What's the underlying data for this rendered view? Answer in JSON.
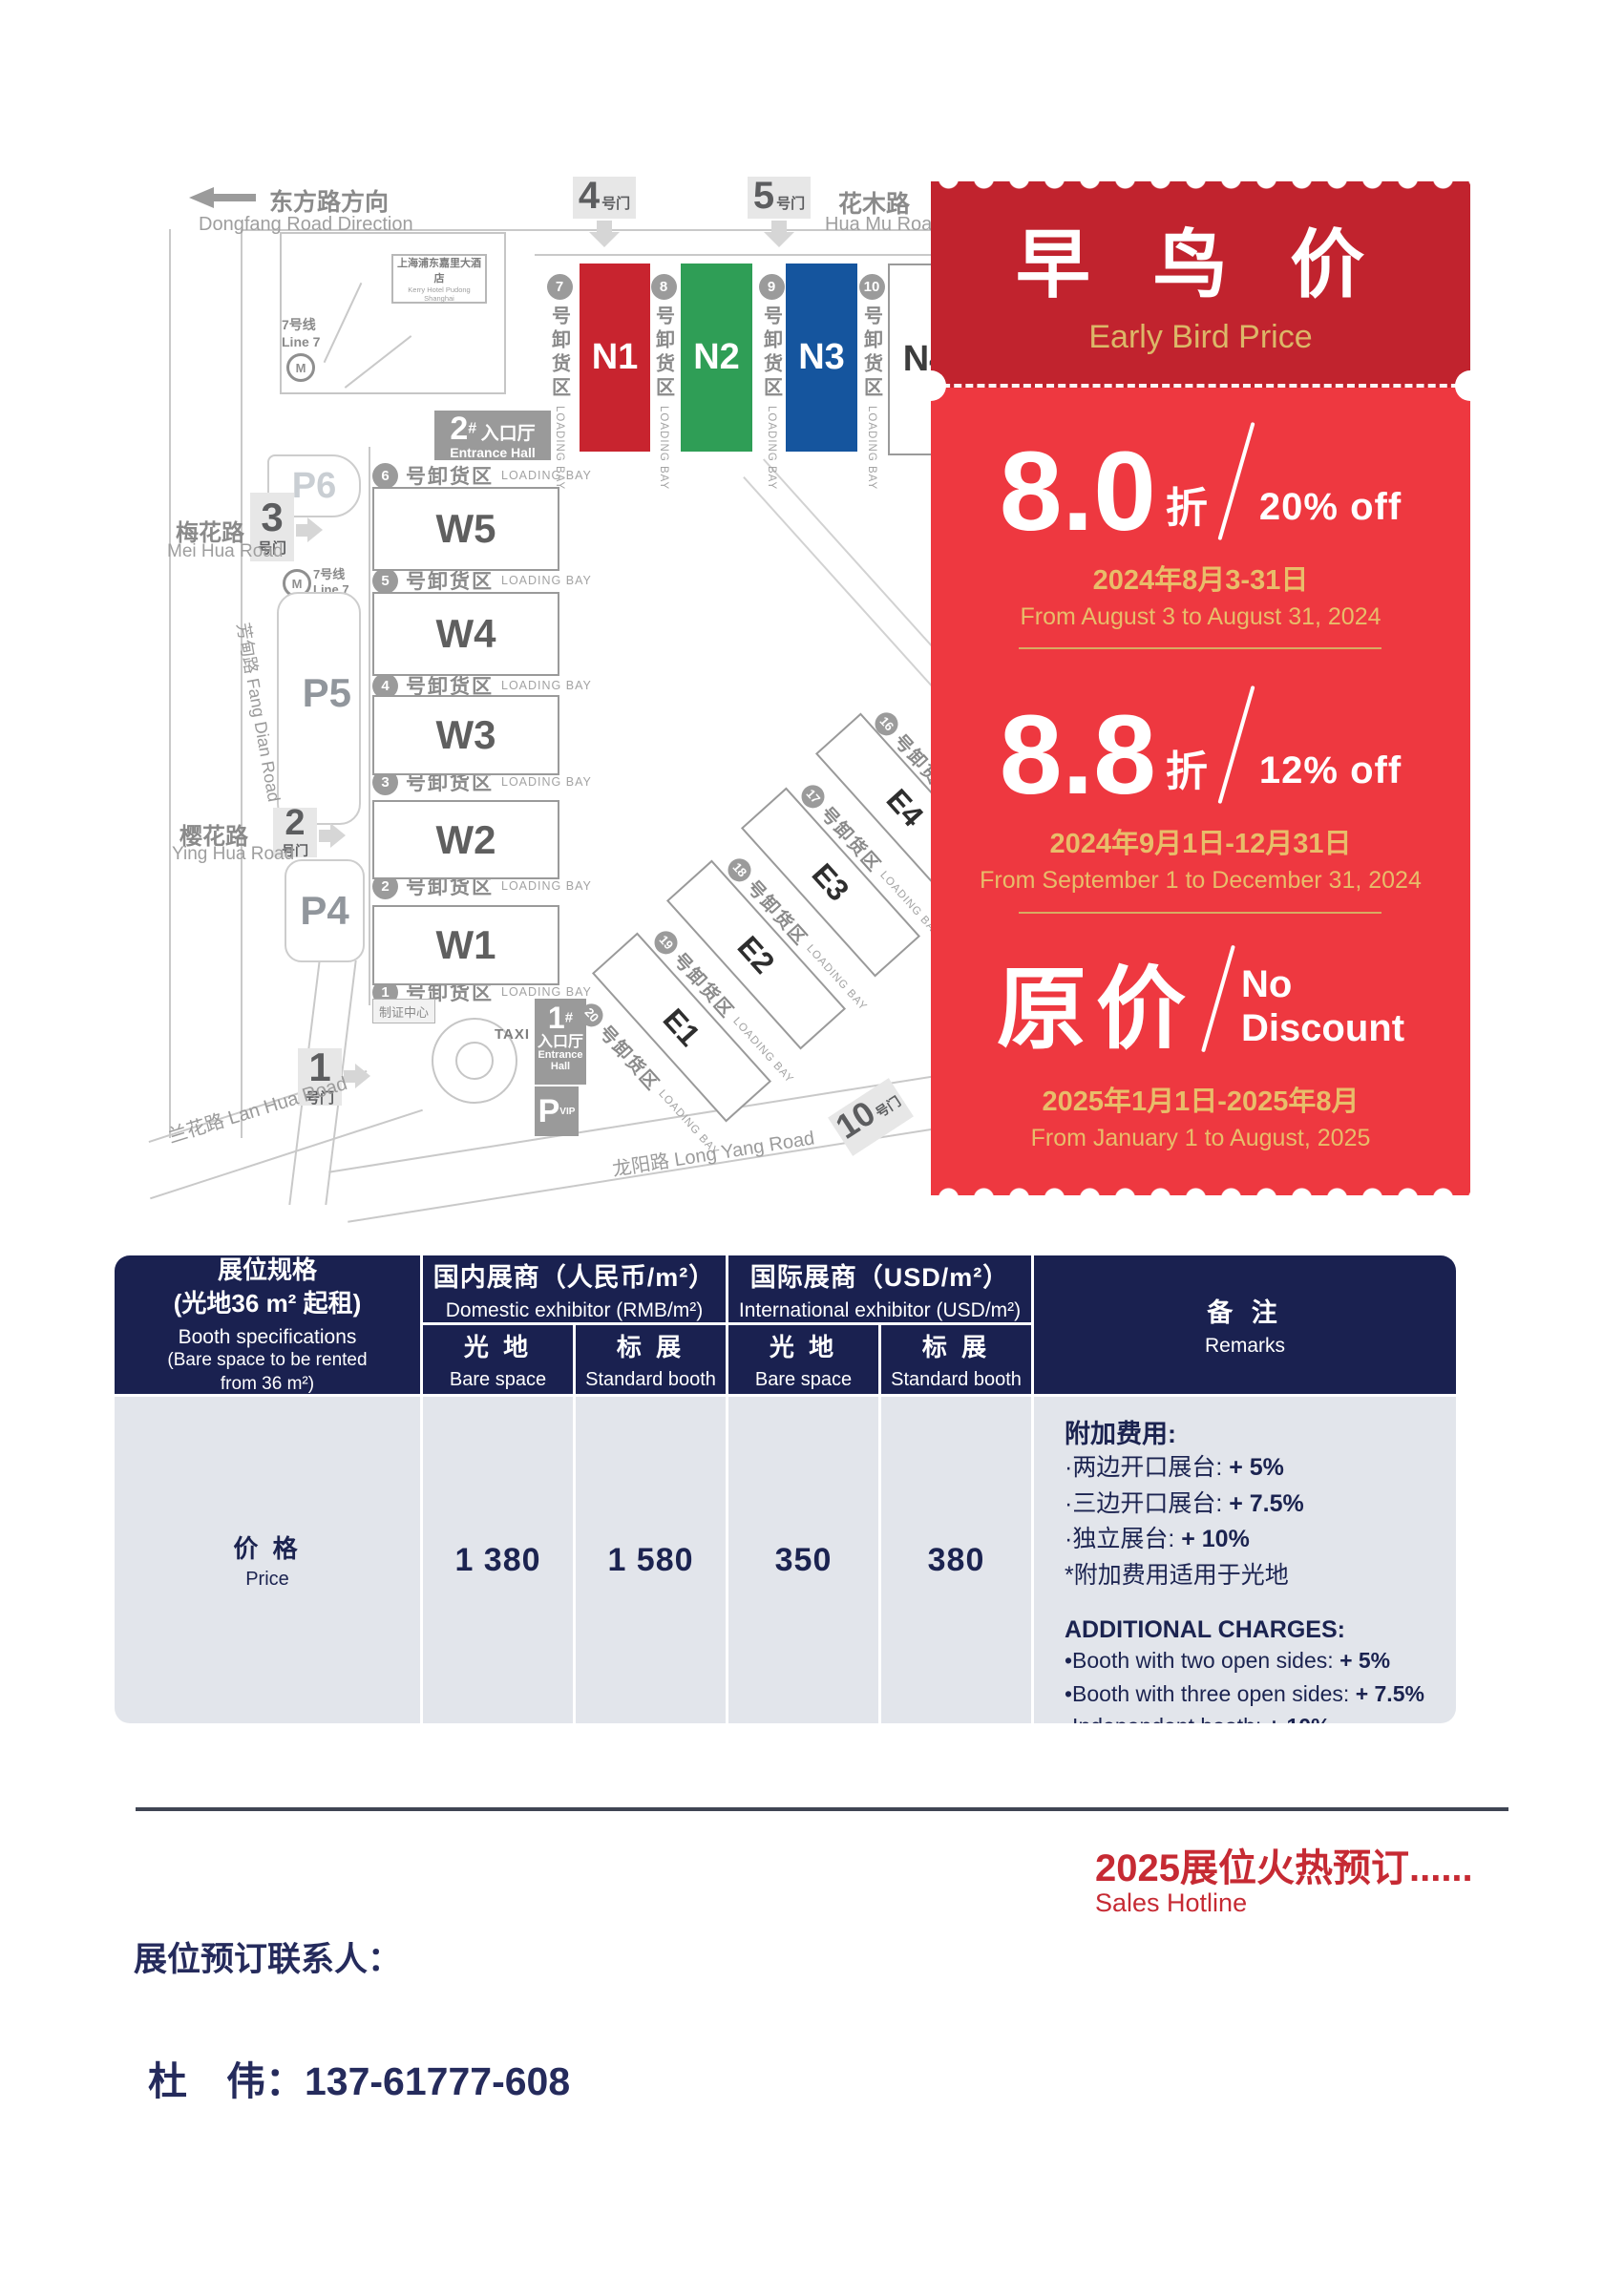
{
  "map": {
    "direction": {
      "zh": "东方路方向",
      "en": "Dongfang Road Direction"
    },
    "roads": {
      "huamu_zh": "花木路",
      "huamu_en": "Hua Mu Road",
      "meihua_zh": "梅花路",
      "meihua_en": "Mei Hua Road",
      "yinghua_zh": "樱花路",
      "yinghua_en": "Ying Hua Road",
      "fangdian": "芳甸路 Fang Dian Road",
      "lanhua": "兰花路 Lan Hua Road",
      "longyang": "龙阳路 Long Yang Road"
    },
    "metro": {
      "zh": "7号线",
      "en": "Line 7"
    },
    "hotel": {
      "zh": "上海浦东嘉里大酒店",
      "en": "Kerry Hotel Pudong Shanghai"
    },
    "gate_suffix": "号门",
    "gates": {
      "g1": "1",
      "g2": "2",
      "g3": "3",
      "g4": "4",
      "g5": "5",
      "g10": "10"
    },
    "entrance1": {
      "num": "1",
      "hash": "#",
      "zh": "入口厅",
      "en1": "Entrance",
      "en2": "Hall"
    },
    "entrance2": {
      "num": "2",
      "hash": "#",
      "zh": "入口厅",
      "en": "Entrance Hall"
    },
    "badge_center": "制证中心",
    "taxi": "TAXI",
    "parking": {
      "p6": "P6",
      "p5": "P5",
      "p4": "P4",
      "pvip_p": "P",
      "pvip_sub": "VIP"
    },
    "loading": {
      "zh": "号卸货区",
      "en": "LOADING BAY"
    },
    "halls_n": {
      "n1": "N1",
      "n2": "N2",
      "n3": "N3",
      "n4": "N4"
    },
    "halls_w": {
      "w5": "W5",
      "w4": "W4",
      "w3": "W3",
      "w2": "W2",
      "w1": "W1"
    },
    "halls_e": {
      "e4": "E4",
      "e3": "E3",
      "e2": "E2",
      "e1": "E1"
    },
    "bays_n": {
      "b7": "7",
      "b8": "8",
      "b9": "9",
      "b10": "10"
    },
    "bays_w": {
      "b6": "6",
      "b5": "5",
      "b4": "4",
      "b3": "3",
      "b2": "2",
      "b1": "1"
    },
    "bays_e": {
      "b16": "16",
      "b17": "17",
      "b18": "18",
      "b19": "19",
      "b20": "20"
    }
  },
  "ticket": {
    "title_zh": "早 鸟 价",
    "title_en": "Early Bird Price",
    "tier1": {
      "num": "8.0",
      "unit": "折",
      "off": "20% off",
      "date_zh": "2024年8月3-31日",
      "date_en": "From August 3 to August 31, 2024"
    },
    "tier2": {
      "num": "8.8",
      "unit": "折",
      "off": "12% off",
      "date_zh": "2024年9月1日-12月31日",
      "date_en": "From September 1 to December 31, 2024"
    },
    "tier3": {
      "num": "原价",
      "off1": "No",
      "off2": "Discount",
      "date_zh": "2025年1月1日-2025年8月",
      "date_en": "From January 1 to August, 2025"
    },
    "colors": {
      "header": "#c1232e",
      "body": "#ee3840",
      "gold": "#dcb768"
    }
  },
  "table": {
    "spec": {
      "zh1": "展位规格",
      "zh2": "(光地36 m² 起租)",
      "en1": "Booth specifications",
      "en2": "(Bare space to be rented",
      "en3": "from 36 m²)"
    },
    "domestic": {
      "zh": "国内展商（人民币/m²）",
      "en": "Domestic exhibitor (RMB/m²)"
    },
    "international": {
      "zh": "国际展商（USD/m²）",
      "en": "International exhibitor (USD/m²)"
    },
    "bare": {
      "zh": "光 地",
      "en": "Bare space"
    },
    "standard": {
      "zh": "标 展",
      "en": "Standard booth"
    },
    "remarks": {
      "zh": "备 注",
      "en": "Remarks"
    },
    "price": {
      "zh": "价 格",
      "en": "Price"
    },
    "values": {
      "v1": "1 380",
      "v2": "1 580",
      "v3": "350",
      "v4": "380"
    },
    "remarks_zh_title": "附加费用:",
    "remarks_zh": [
      {
        "t": "·两边开口展台: ",
        "v": "+ 5%"
      },
      {
        "t": "·三边开口展台: ",
        "v": "+ 7.5%"
      },
      {
        "t": "·独立展台: ",
        "v": "+ 10%"
      },
      {
        "t": "*附加费用适用于光地",
        "v": ""
      }
    ],
    "remarks_en_title": "ADDITIONAL CHARGES:",
    "remarks_en": [
      {
        "t": "•Booth with two open sides: ",
        "v": "+ 5%"
      },
      {
        "t": "•Booth with three open sides: ",
        "v": "+ 7.5%"
      },
      {
        "t": "•Independent booth: ",
        "v": "+ 10%"
      },
      {
        "t": "*Additional charges apply to bare space",
        "v": ""
      }
    ]
  },
  "footer": {
    "promo_zh": "2025展位火热预订......",
    "promo_en": "Sales Hotline",
    "contact_label": "展位预订联系人：",
    "contact_name": "杜　伟：",
    "contact_phone": "137-61777-608"
  }
}
